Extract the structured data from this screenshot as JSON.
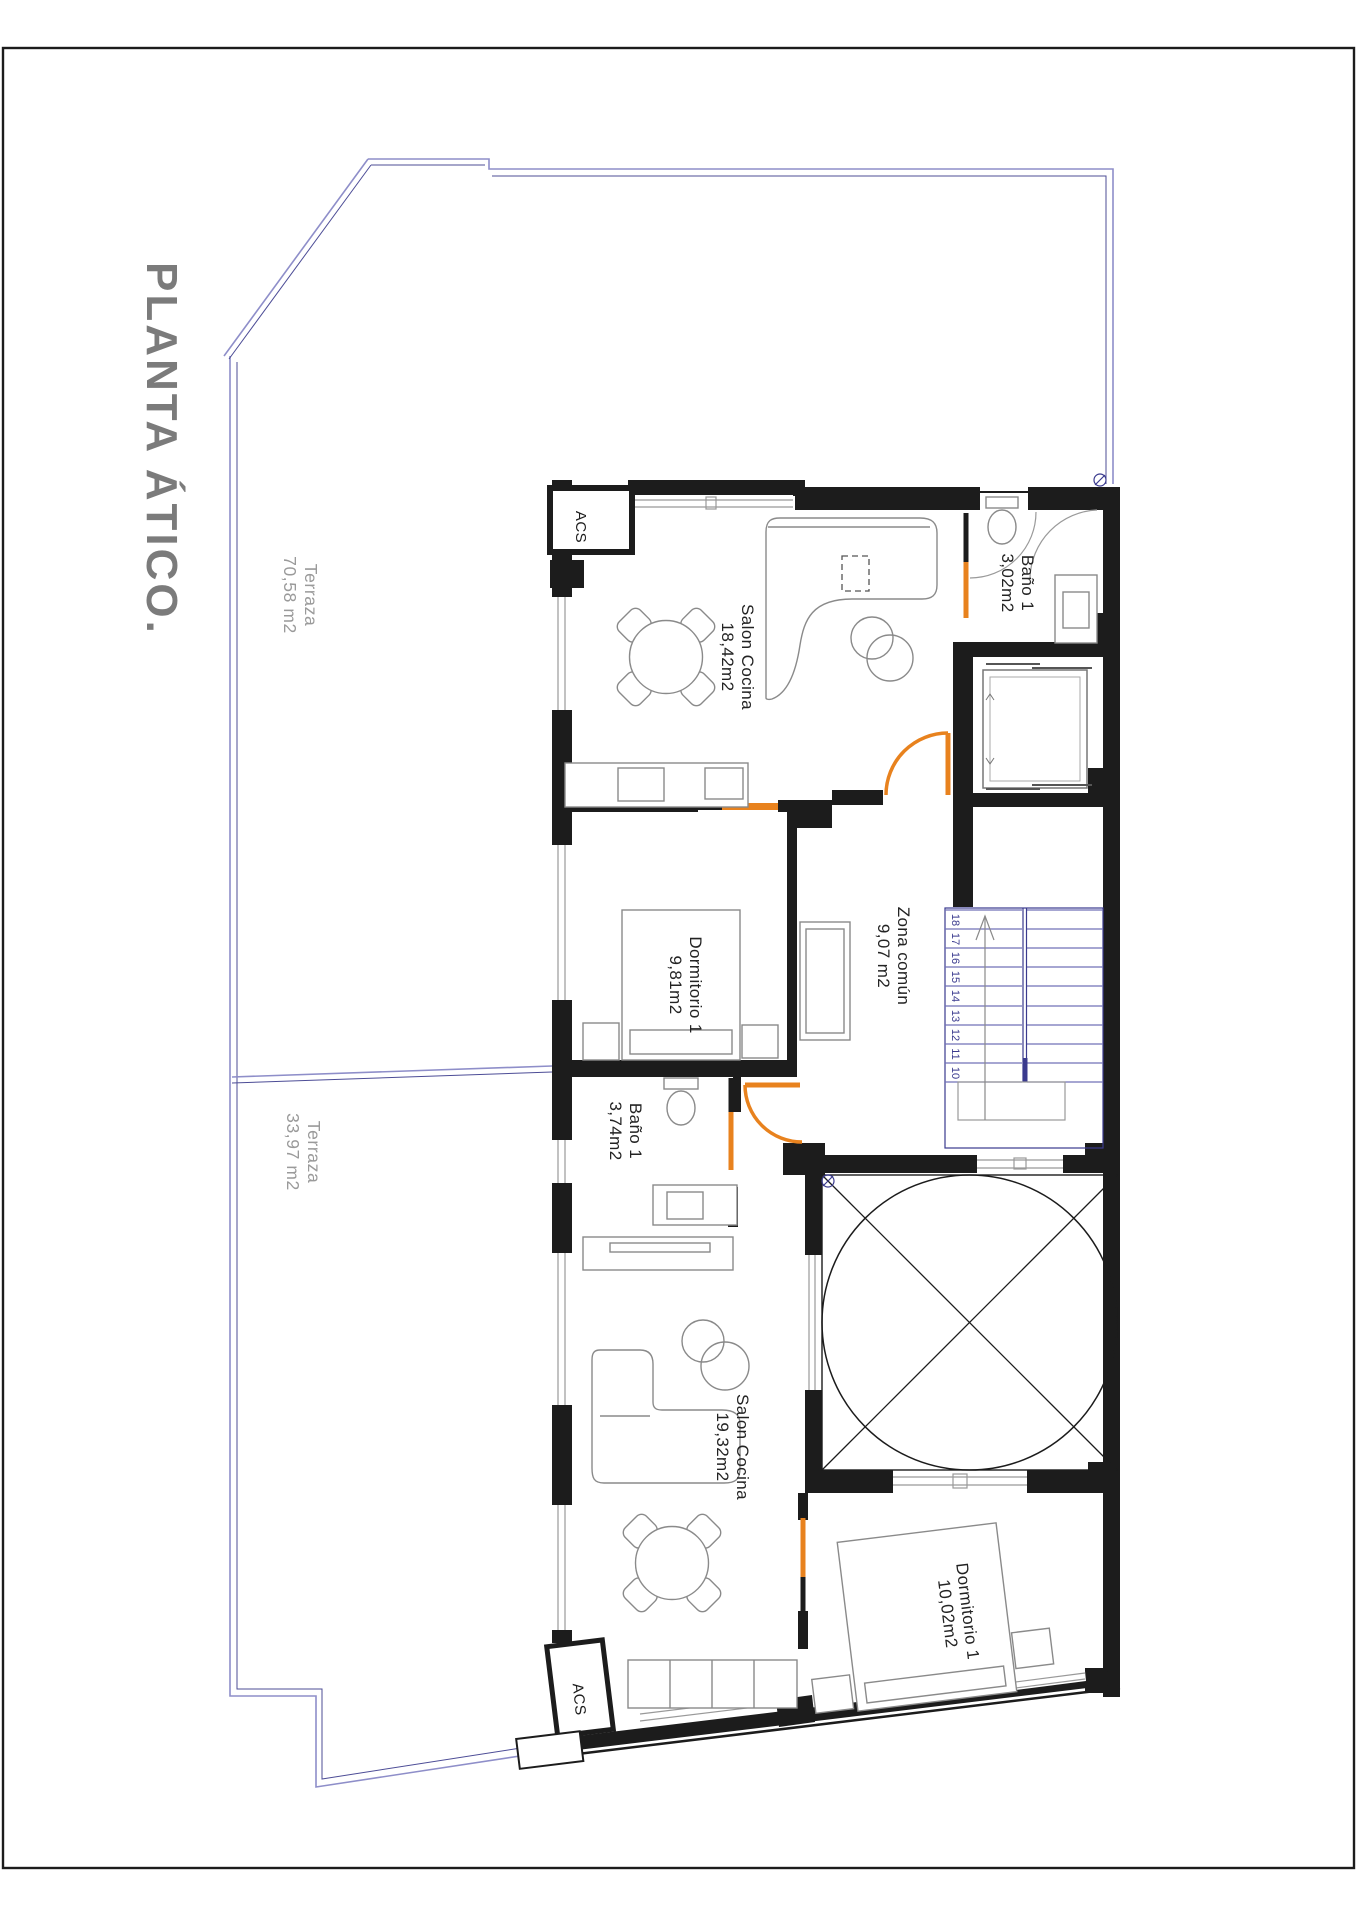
{
  "title": "PLANTA ÁTICO.",
  "colors": {
    "walls": "#1c1c1c",
    "doors": "#e8821e",
    "stairs": "#3a3a8e",
    "terrace_line": "#8e8ec9",
    "room_label": "#232323",
    "terrace_label": "#9a9a9a",
    "title_gray": "#7b7b7b"
  },
  "rooms": {
    "salon_a": {
      "name": "Salon Cocina",
      "area": "18,42m2"
    },
    "bano_a": {
      "name": "Baño 1",
      "area": "3,02m2"
    },
    "dorm_a": {
      "name": "Dormitorio 1",
      "area": "9,81m2"
    },
    "zona": {
      "name": "Zona común",
      "area": "9,07 m2"
    },
    "bano_b": {
      "name": "Baño 1",
      "area": "3,74m2"
    },
    "salon_b": {
      "name": "Salon Cocina",
      "area": "19,32m2"
    },
    "dorm_b": {
      "name": "Dormitorio 1",
      "area": "10,02m2"
    },
    "terraza_a": {
      "name": "Terraza",
      "area": "70,58 m2"
    },
    "terraza_b": {
      "name": "Terraza",
      "area": "33,97 m2"
    }
  },
  "closets": {
    "acs_top": "ACS",
    "acs_bottom": "ACS"
  },
  "stairs": {
    "numbers": [
      "18",
      "17",
      "16",
      "15",
      "14",
      "13",
      "12",
      "11",
      "10"
    ]
  }
}
